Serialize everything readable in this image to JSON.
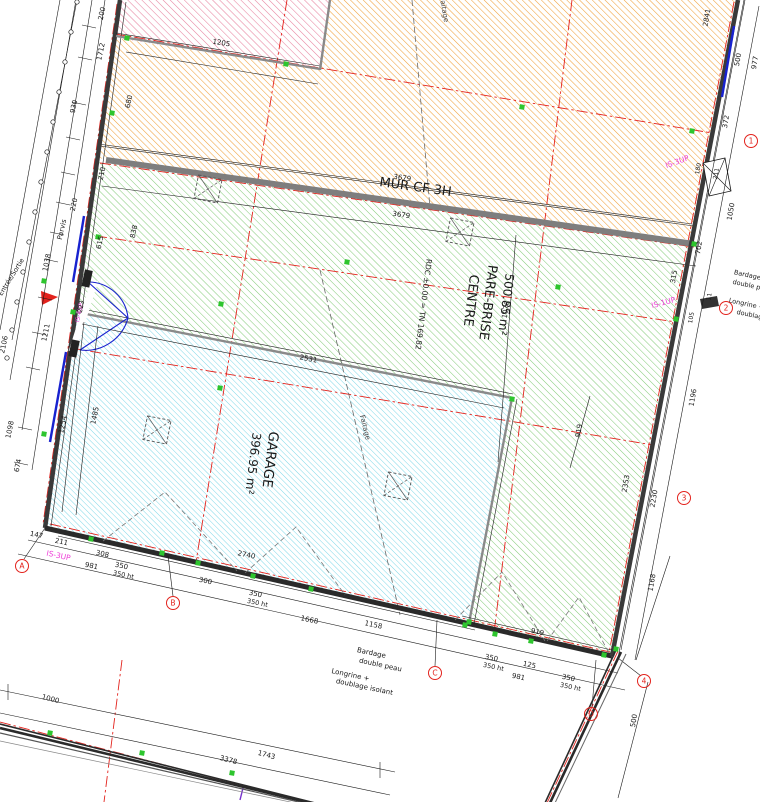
{
  "drawing_title": "Plan RDC - Centre Pare-Brise / Garage",
  "colors": {
    "hatch_pink": "#e8839f",
    "hatch_orange": "#f0a23c",
    "hatch_green": "#85cc7a",
    "hatch_cyan": "#7fd8e8",
    "axis_red": "#e3231d",
    "marker_green": "#2ec52e",
    "magenta": "#e племя",
    "annotation_magenta": "#ee3fd8",
    "wall_gray": "#7e7e7e",
    "line_black": "#1a1a1a",
    "door_blue": "#1822cf"
  },
  "rooms": [
    {
      "name": "CENTRE PARE-BRISE",
      "area": "500.85 m²",
      "fill": "green-hatch"
    },
    {
      "name": "GARAGE",
      "area": "396.95 m²",
      "fill": "cyan-hatch"
    }
  ],
  "notes": {
    "fire_wall": "MUR CF 3H",
    "level": "RDC ±0.00 = TN 169,82",
    "cladding": "Bardage double peau",
    "sill": "Longrine + doublage isolant",
    "ridge": "Faitage",
    "entrance": "Entrée/Sortie",
    "forecourt": "Parvis"
  },
  "texts": [
    {
      "n": "room-centre-name-1",
      "t": "CENTRE",
      "x": 467,
      "y": 300,
      "r": 97,
      "s": 13
    },
    {
      "n": "room-centre-name-2",
      "t": "PARE-BRISE",
      "x": 484,
      "y": 302,
      "r": 97,
      "s": 13
    },
    {
      "n": "room-centre-area",
      "t": "500.85 m²",
      "x": 502,
      "y": 304,
      "r": 97,
      "s": 12
    },
    {
      "n": "level-note",
      "t": "RDC ±0.00 = TN 169,82",
      "x": 421,
      "y": 304,
      "r": 97,
      "s": 7.5
    },
    {
      "n": "room-garage-name",
      "t": "GARAGE",
      "x": 266,
      "y": 459,
      "r": 97,
      "s": 13.5
    },
    {
      "n": "room-garage-area",
      "t": "396.95 m²",
      "x": 249,
      "y": 463,
      "r": 97,
      "s": 12
    },
    {
      "n": "fire-wall-label",
      "t": "MUR CF 3H",
      "x": 415,
      "y": 191,
      "r": 8,
      "s": 13
    },
    {
      "n": "ridge-label-garage",
      "t": "Faitage",
      "x": 363,
      "y": 428,
      "r": 76,
      "s": 7,
      "c": "#444"
    },
    {
      "n": "ridge-label-top",
      "t": "Faitage",
      "x": 442,
      "y": 10,
      "r": 80,
      "s": 7,
      "c": "#444"
    },
    {
      "n": "forecourt-label",
      "t": "Parvis",
      "x": 64,
      "y": 230,
      "r": -77,
      "s": 7
    },
    {
      "n": "entrance-label",
      "t": "Entrée/Sortie",
      "x": 13,
      "y": 278,
      "r": -58,
      "s": 6.5
    },
    {
      "n": "cladding-label-1",
      "t": "Bardage",
      "x": 371,
      "y": 655,
      "r": 12,
      "s": 7
    },
    {
      "n": "cladding-label-2",
      "t": "double peau",
      "x": 380,
      "y": 667,
      "r": 12,
      "s": 7
    },
    {
      "n": "sill-label-1",
      "t": "Longrine +",
      "x": 350,
      "y": 677,
      "r": 12,
      "s": 7
    },
    {
      "n": "sill-label-2",
      "t": "doublage isolant",
      "x": 364,
      "y": 689,
      "r": 12,
      "s": 7
    },
    {
      "n": "cladding-right-1",
      "t": "Bardage",
      "x": 747,
      "y": 277,
      "r": 12,
      "s": 6.5
    },
    {
      "n": "cladding-right-2",
      "t": "double peau",
      "x": 752,
      "y": 288,
      "r": 12,
      "s": 6.5
    },
    {
      "n": "sill-right-1",
      "t": "Longrine +",
      "x": 746,
      "y": 306,
      "r": 12,
      "s": 6.5
    },
    {
      "n": "sill-right-2",
      "t": "doublage",
      "x": 751,
      "y": 317,
      "r": 12,
      "s": 6.5
    },
    {
      "n": "is-label-right-top",
      "t": "IS-3UP",
      "x": 678,
      "y": 164,
      "r": -20,
      "s": 7.5,
      "c": "#ee3fd8"
    },
    {
      "n": "is-label-right-mid",
      "t": "IS-1UP",
      "x": 664,
      "y": 305,
      "r": -15,
      "s": 7.5,
      "c": "#ee3fd8"
    },
    {
      "n": "is-label-bottom-left",
      "t": "IS-3UP",
      "x": 58,
      "y": 558,
      "r": 12,
      "s": 7.5,
      "c": "#ee3fd8"
    },
    {
      "n": "is-label-entrance",
      "t": "IS-4UP",
      "x": 81,
      "y": 313,
      "r": -78,
      "s": 6,
      "c": "#ee3fd8"
    },
    {
      "n": "dim",
      "t": "200",
      "x": 104,
      "y": 14,
      "r": -78,
      "s": 7
    },
    {
      "n": "dim",
      "t": "1712",
      "x": 103,
      "y": 52,
      "r": -78,
      "s": 7
    },
    {
      "n": "dim",
      "t": "930",
      "x": 76,
      "y": 107,
      "r": -78,
      "s": 7
    },
    {
      "n": "dim",
      "t": "680",
      "x": 131,
      "y": 102,
      "r": -78,
      "s": 7
    },
    {
      "n": "dim",
      "t": "220",
      "x": 76,
      "y": 205,
      "r": -78,
      "s": 7
    },
    {
      "n": "dim",
      "t": "210",
      "x": 104,
      "y": 174,
      "r": -78,
      "s": 7
    },
    {
      "n": "dim",
      "t": "615",
      "x": 102,
      "y": 243,
      "r": -78,
      "s": 7
    },
    {
      "n": "dim",
      "t": "838",
      "x": 136,
      "y": 232,
      "r": -78,
      "s": 7
    },
    {
      "n": "dim",
      "t": "1038",
      "x": 49,
      "y": 263,
      "r": -78,
      "s": 7
    },
    {
      "n": "dim",
      "t": "223",
      "x": 83,
      "y": 307,
      "r": -78,
      "s": 6.5
    },
    {
      "n": "dim",
      "t": "1211",
      "x": 48,
      "y": 333,
      "r": -78,
      "s": 7
    },
    {
      "n": "dim",
      "t": "2106",
      "x": 6,
      "y": 345,
      "r": -78,
      "s": 7
    },
    {
      "n": "dim",
      "t": "1098",
      "x": 12,
      "y": 430,
      "r": -78,
      "s": 7
    },
    {
      "n": "dim",
      "t": "674",
      "x": 20,
      "y": 466,
      "r": -78,
      "s": 7
    },
    {
      "n": "dim",
      "t": "1254",
      "x": 65,
      "y": 425,
      "r": -78,
      "s": 7
    },
    {
      "n": "dim",
      "t": "1485",
      "x": 97,
      "y": 416,
      "r": -78,
      "s": 7
    },
    {
      "n": "dim",
      "t": "147",
      "x": 36,
      "y": 537,
      "r": 12,
      "s": 7
    },
    {
      "n": "dim",
      "t": "211",
      "x": 61,
      "y": 544,
      "r": 12,
      "s": 7
    },
    {
      "n": "dim",
      "t": "308",
      "x": 102,
      "y": 556,
      "r": 12,
      "s": 7
    },
    {
      "n": "dim",
      "t": "981",
      "x": 91,
      "y": 568,
      "r": 12,
      "s": 7
    },
    {
      "n": "dim",
      "t": "350",
      "x": 121,
      "y": 568,
      "r": 12,
      "s": 7
    },
    {
      "n": "dim",
      "t": "350 ht",
      "x": 123,
      "y": 577,
      "r": 12,
      "s": 6.5
    },
    {
      "n": "dim",
      "t": "300",
      "x": 205,
      "y": 583,
      "r": 12,
      "s": 7
    },
    {
      "n": "dim",
      "t": "350",
      "x": 255,
      "y": 596,
      "r": 12,
      "s": 7
    },
    {
      "n": "dim",
      "t": "350 ht",
      "x": 257,
      "y": 605,
      "r": 12,
      "s": 6.5
    },
    {
      "n": "dim",
      "t": "1668",
      "x": 309,
      "y": 622,
      "r": 12,
      "s": 7
    },
    {
      "n": "dim",
      "t": "2740",
      "x": 246,
      "y": 557,
      "r": 12,
      "s": 7
    },
    {
      "n": "dim",
      "t": "1158",
      "x": 373,
      "y": 627,
      "r": 12,
      "s": 7
    },
    {
      "n": "dim",
      "t": "350",
      "x": 491,
      "y": 660,
      "r": 12,
      "s": 7
    },
    {
      "n": "dim",
      "t": "350 ht",
      "x": 493,
      "y": 669,
      "r": 12,
      "s": 6.5
    },
    {
      "n": "dim",
      "t": "125",
      "x": 529,
      "y": 667,
      "r": 12,
      "s": 7
    },
    {
      "n": "dim",
      "t": "981",
      "x": 518,
      "y": 679,
      "r": 12,
      "s": 7
    },
    {
      "n": "dim",
      "t": "350",
      "x": 568,
      "y": 680,
      "r": 12,
      "s": 7
    },
    {
      "n": "dim",
      "t": "350 ht",
      "x": 570,
      "y": 689,
      "r": 12,
      "s": 6.5
    },
    {
      "n": "dim",
      "t": "919",
      "x": 537,
      "y": 634,
      "r": 12,
      "s": 7
    },
    {
      "n": "dim",
      "t": "1000",
      "x": 50,
      "y": 701,
      "r": 15,
      "s": 7
    },
    {
      "n": "dim",
      "t": "3378",
      "x": 228,
      "y": 762,
      "r": 15,
      "s": 7
    },
    {
      "n": "dim",
      "t": "1743",
      "x": 266,
      "y": 757,
      "r": 15,
      "s": 7
    },
    {
      "n": "dim",
      "t": "2841",
      "x": 709,
      "y": 18,
      "r": -80,
      "s": 7
    },
    {
      "n": "dim",
      "t": "500",
      "x": 740,
      "y": 60,
      "r": -80,
      "s": 7
    },
    {
      "n": "dim",
      "t": "977",
      "x": 757,
      "y": 63,
      "r": -80,
      "s": 7
    },
    {
      "n": "dim",
      "t": "372",
      "x": 728,
      "y": 122,
      "r": -80,
      "s": 7
    },
    {
      "n": "dim",
      "t": "180",
      "x": 700,
      "y": 169,
      "r": -80,
      "s": 6
    },
    {
      "n": "dim",
      "t": "211",
      "x": 718,
      "y": 174,
      "r": -80,
      "s": 6
    },
    {
      "n": "dim",
      "t": "1050",
      "x": 733,
      "y": 212,
      "r": -80,
      "s": 7
    },
    {
      "n": "dim",
      "t": "702",
      "x": 701,
      "y": 248,
      "r": -80,
      "s": 7
    },
    {
      "n": "dim",
      "t": "315",
      "x": 676,
      "y": 277,
      "r": -80,
      "s": 7
    },
    {
      "n": "dim",
      "t": "11",
      "x": 711,
      "y": 297,
      "r": -80,
      "s": 6
    },
    {
      "n": "dim",
      "t": "105",
      "x": 693,
      "y": 318,
      "r": -80,
      "s": 6
    },
    {
      "n": "dim",
      "t": "1196",
      "x": 695,
      "y": 398,
      "r": -80,
      "s": 7
    },
    {
      "n": "dim",
      "t": "2353",
      "x": 628,
      "y": 484,
      "r": -80,
      "s": 7
    },
    {
      "n": "dim",
      "t": "2230",
      "x": 656,
      "y": 499,
      "r": -80,
      "s": 7
    },
    {
      "n": "dim",
      "t": "1168",
      "x": 654,
      "y": 583,
      "r": -80,
      "s": 7
    },
    {
      "n": "dim",
      "t": "500",
      "x": 636,
      "y": 721,
      "r": -80,
      "s": 7
    },
    {
      "n": "dim",
      "t": "3679",
      "x": 402,
      "y": 180,
      "r": 8,
      "s": 7
    },
    {
      "n": "dim",
      "t": "3679",
      "x": 401,
      "y": 217,
      "r": 8,
      "s": 7
    },
    {
      "n": "dim",
      "t": "1205",
      "x": 221,
      "y": 45,
      "r": 9,
      "s": 7
    },
    {
      "n": "dim",
      "t": "2531",
      "x": 308,
      "y": 361,
      "r": 11,
      "s": 7
    },
    {
      "n": "dim",
      "t": "1076",
      "x": 508,
      "y": 310,
      "r": -80,
      "s": 7
    },
    {
      "n": "dim",
      "t": "919",
      "x": 581,
      "y": 431,
      "r": -80,
      "s": 7
    }
  ],
  "grid_bubbles": [
    {
      "label": "A",
      "x": 22,
      "y": 566
    },
    {
      "label": "B",
      "x": 173,
      "y": 603
    },
    {
      "label": "C",
      "x": 435,
      "y": 673
    },
    {
      "label": "D",
      "x": 591,
      "y": 714
    },
    {
      "label": "1",
      "x": 751,
      "y": 141
    },
    {
      "label": "2",
      "x": 726,
      "y": 308
    },
    {
      "label": "3",
      "x": 684,
      "y": 498
    },
    {
      "label": "4",
      "x": 644,
      "y": 681
    }
  ],
  "columns": [
    {
      "x": 208,
      "y": 189
    },
    {
      "x": 460,
      "y": 232
    },
    {
      "x": 157,
      "y": 430
    },
    {
      "x": 398,
      "y": 486
    }
  ],
  "green_markers": [
    {
      "x": 127,
      "y": 38
    },
    {
      "x": 286,
      "y": 64
    },
    {
      "x": 522,
      "y": 107
    },
    {
      "x": 692,
      "y": 131
    },
    {
      "x": 347,
      "y": 262
    },
    {
      "x": 98,
      "y": 237
    },
    {
      "x": 676,
      "y": 319
    },
    {
      "x": 221,
      "y": 304
    },
    {
      "x": 220,
      "y": 388
    },
    {
      "x": 112,
      "y": 113
    },
    {
      "x": 44,
      "y": 434
    },
    {
      "x": 91,
      "y": 539
    },
    {
      "x": 162,
      "y": 553
    },
    {
      "x": 253,
      "y": 576
    },
    {
      "x": 311,
      "y": 589
    },
    {
      "x": 465,
      "y": 625
    },
    {
      "x": 531,
      "y": 641
    },
    {
      "x": 604,
      "y": 655
    },
    {
      "x": 694,
      "y": 244
    },
    {
      "x": 616,
      "y": 649
    },
    {
      "x": 558,
      "y": 287
    },
    {
      "x": 44,
      "y": 281
    },
    {
      "x": 198,
      "y": 563
    },
    {
      "x": 495,
      "y": 634
    },
    {
      "x": 73,
      "y": 312
    },
    {
      "x": 512,
      "y": 399
    },
    {
      "x": 469,
      "y": 622
    },
    {
      "x": 50,
      "y": 733
    },
    {
      "x": 142,
      "y": 753
    },
    {
      "x": 232,
      "y": 773
    }
  ],
  "fence_posts": [
    {
      "x": 77,
      "y": 2
    },
    {
      "x": 71,
      "y": 32
    },
    {
      "x": 65,
      "y": 62
    },
    {
      "x": 59,
      "y": 92
    },
    {
      "x": 53,
      "y": 122
    },
    {
      "x": 47,
      "y": 152
    },
    {
      "x": 41,
      "y": 182
    },
    {
      "x": 35,
      "y": 212
    },
    {
      "x": 29,
      "y": 242
    },
    {
      "x": 23,
      "y": 272
    },
    {
      "x": 17,
      "y": 302
    },
    {
      "x": 12,
      "y": 330
    },
    {
      "x": 7,
      "y": 358
    }
  ],
  "door_swing_symbols": [
    {
      "points": "103,541 165,492 237,571"
    },
    {
      "points": "245,573 296,527 345,595"
    },
    {
      "points": "455,620 502,572 545,641"
    },
    {
      "points": "547,641 579,597 610,655"
    }
  ]
}
